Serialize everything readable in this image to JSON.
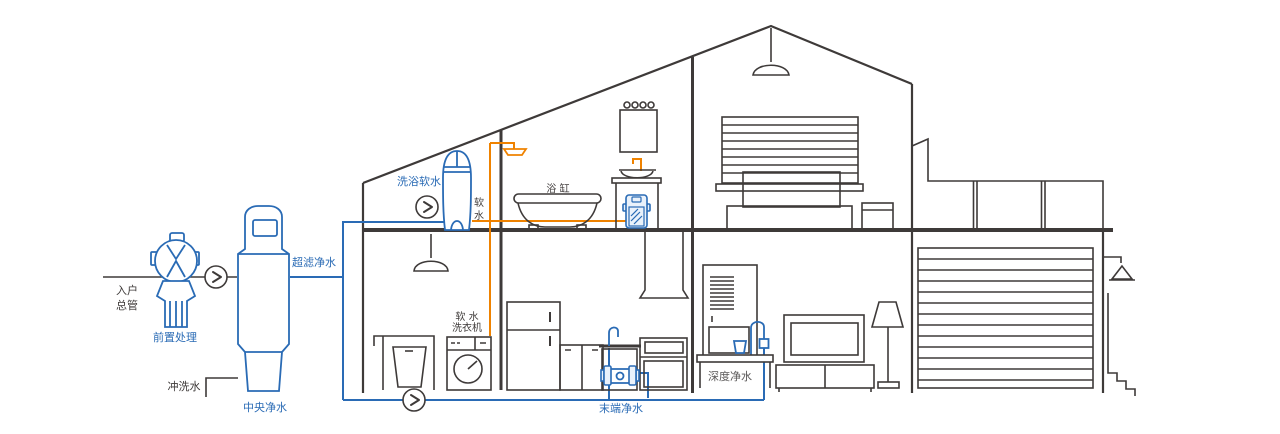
{
  "diagram": {
    "type": "whole-house-water-purification-schematic",
    "colors": {
      "outline": "#3e3a39",
      "water_blue": "#2a6bb5",
      "soft_water_orange": "#ef8200",
      "gray_label": "#595757",
      "device_fill": "#eaf2fb"
    },
    "labels": {
      "inlet_main_line1": "入户",
      "inlet_main_line2": "总管",
      "pre_treatment": "前置处理",
      "flush_water": "冲洗水",
      "central_purification": "中央净水",
      "ultrafiltration": "超滤净水",
      "bath_soft_water": "洗浴软水",
      "soft_water_char1": "软",
      "soft_water_char2": "水",
      "bathtub": "浴 缸",
      "soft_water_washer_line1": "软 水",
      "soft_water_washer_line2": "洗衣机",
      "terminal_purification": "末端净水",
      "deep_purification": "深度净水"
    }
  }
}
